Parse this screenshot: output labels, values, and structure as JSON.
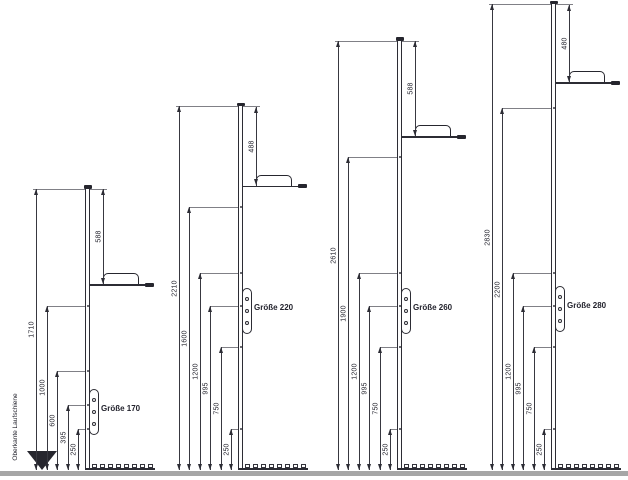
{
  "drawing": {
    "baseline_label": "Oberkante Laufschiene",
    "profiles": [
      {
        "name": "Größe 170",
        "total_mm": 1710,
        "handle_from_top_mm": 588,
        "left_dims_mm": [
          1710,
          1000,
          600,
          395,
          250
        ]
      },
      {
        "name": "Größe 220",
        "total_mm": 2210,
        "handle_from_top_mm": 488,
        "left_dims_mm": [
          2210,
          1600,
          1200,
          995,
          750,
          250
        ]
      },
      {
        "name": "Größe 260",
        "total_mm": 2610,
        "handle_from_top_mm": 588,
        "left_dims_mm": [
          2610,
          1900,
          1200,
          995,
          750,
          250
        ]
      },
      {
        "name": "Größe 280",
        "total_mm": 2830,
        "handle_from_top_mm": 480,
        "left_dims_mm": [
          2830,
          2200,
          1200,
          995,
          750,
          250
        ]
      }
    ],
    "colors": {
      "line": "#2c2c34",
      "label": "#23232d",
      "ground": "#a6a6a6"
    }
  }
}
